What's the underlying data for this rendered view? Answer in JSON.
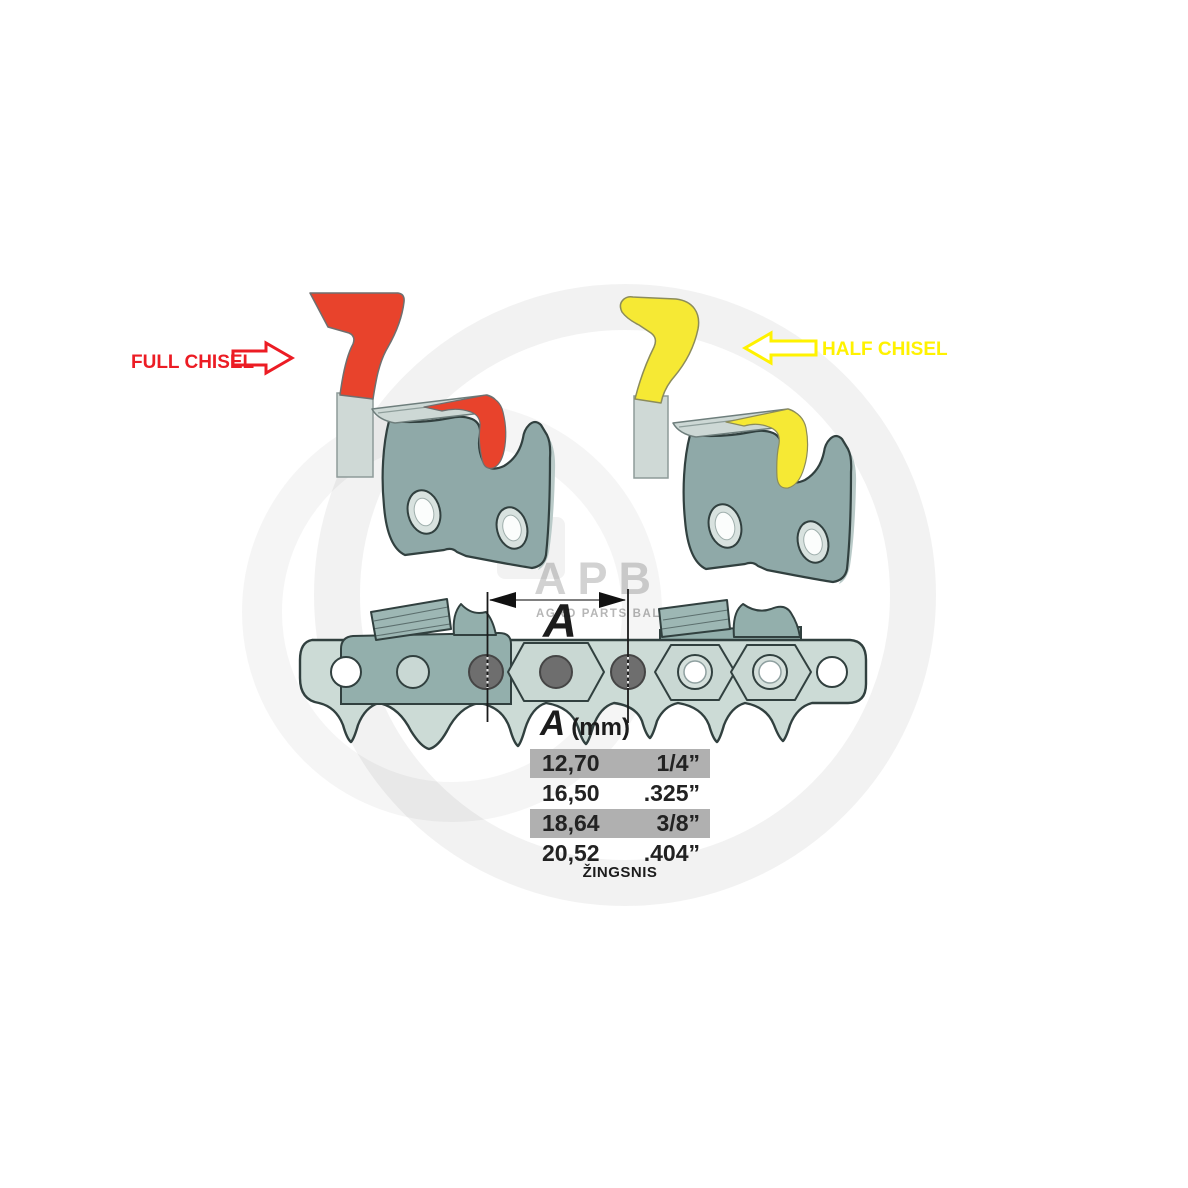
{
  "labels": {
    "full_chisel": "FULL CHISEL",
    "half_chisel": "HALF CHISEL"
  },
  "watermark": {
    "logo": "APB",
    "subtitle": "AGRO PARTS BALTIJA"
  },
  "dimension": {
    "label": "A"
  },
  "table": {
    "header": {
      "dimension": "A",
      "unit": "(mm)"
    },
    "rows": [
      {
        "mm": "12,70",
        "inch": "1/4”",
        "highlighted": true
      },
      {
        "mm": "16,50",
        "inch": ".325”",
        "highlighted": false
      },
      {
        "mm": "18,64",
        "inch": "3/8”",
        "highlighted": true
      },
      {
        "mm": "20,52",
        "inch": ".404”",
        "highlighted": false
      }
    ],
    "caption": "ŽINGSNIS"
  },
  "icons": {
    "full_chisel_arrow": "block-arrow-right-outline",
    "half_chisel_arrow": "block-arrow-left-outline"
  },
  "colors": {
    "full_chisel_accent": "#EC1C24",
    "full_chisel_fill": "#E8432C",
    "half_chisel_accent": "#FFF200",
    "half_chisel_fill": "#F6E934",
    "cutter_body": "#8FA9A8",
    "chain_link": "#CCDBD6",
    "rivet": "#6E6E6E",
    "row_highlight": "#B0B0B0"
  }
}
